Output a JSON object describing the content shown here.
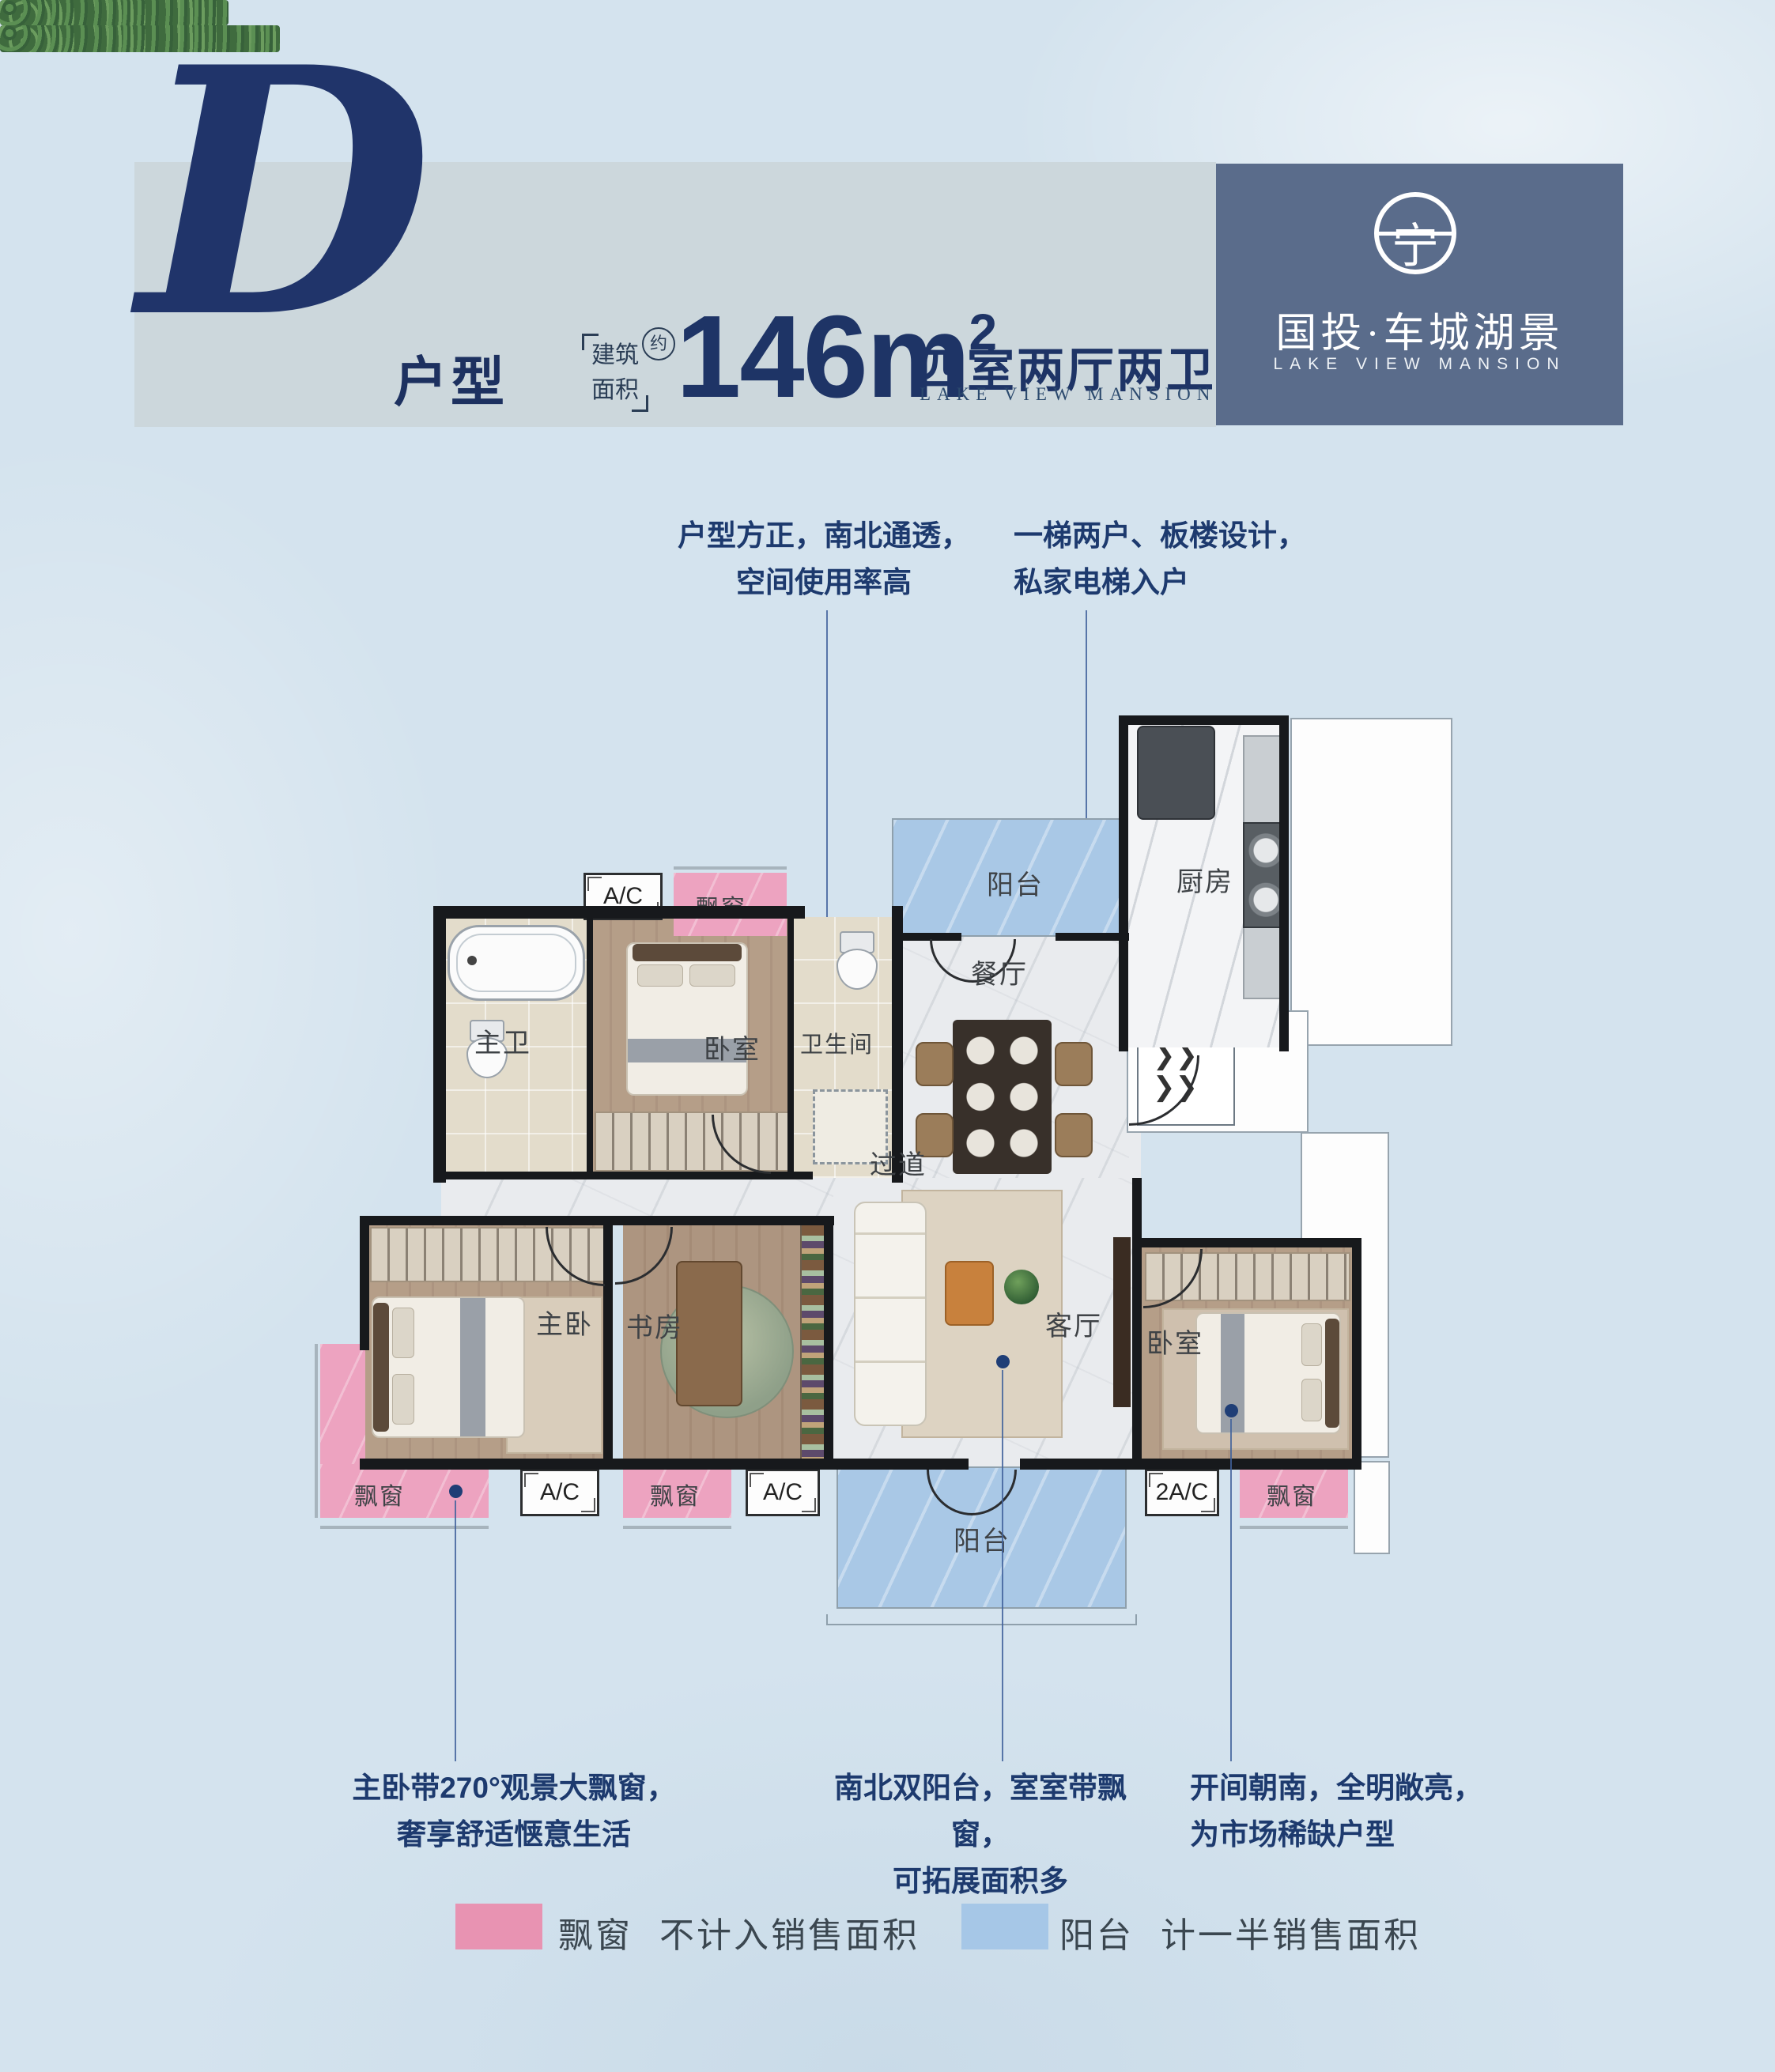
{
  "header": {
    "letter": "D",
    "letter_suffix": "户型",
    "area_label_line1": "建筑",
    "area_label_line2": "面积",
    "area_approx": "约",
    "area_value": "146m",
    "area_sup": "2",
    "spec": "四室两厅两卫",
    "spec_sub": "LAKE VIEW MANSION"
  },
  "brand": {
    "emblem_char": "宁",
    "name": "国投·车城湖景",
    "sub": "LAKE VIEW MANSION",
    "bg_color": "#5a6c8b"
  },
  "callouts": {
    "top_left": {
      "line1": "户型方正，南北通透，",
      "line2": "空间使用率高"
    },
    "top_right": {
      "line1": "一梯两户、板楼设计，",
      "line2": "私家电梯入户"
    },
    "bottom_left": {
      "line1": "主卧带270°观景大飘窗，",
      "line2": "奢享舒适惬意生活"
    },
    "bottom_mid": {
      "line1": "南北双阳台，室室带飘窗，",
      "line2": "可拓展面积多"
    },
    "bottom_right": {
      "line1": "开间朝南，全明敞亮，",
      "line2": "为市场稀缺户型"
    }
  },
  "plan": {
    "rooms": {
      "balcony_north": "阳台",
      "kitchen": "厨房",
      "master_bath": "主卫",
      "bedroom_north": "卧室",
      "bathroom": "卫生间",
      "dining": "餐厅",
      "corridor": "过道",
      "master_bedroom": "主卧",
      "study": "书房",
      "living": "客厅",
      "bedroom_south": "卧室",
      "balcony_south": "阳台"
    },
    "bays": {
      "top": "飘窗",
      "left": "飘窗",
      "mid": "飘窗",
      "right": "飘窗"
    },
    "ac": {
      "top": "A/C",
      "left": "A/C",
      "mid": "A/C",
      "right": "2A/C"
    },
    "colors": {
      "bay": "#eda3c0",
      "balcony": "#a9c8e6",
      "wall": "#17191c",
      "wood": "#b59e88",
      "marble": "#e9ebee"
    }
  },
  "legend": {
    "bay": {
      "label": "飘窗",
      "desc": "不计入销售面积",
      "color": "#e893b2"
    },
    "balcony": {
      "label": "阳台",
      "desc": "计一半销售面积",
      "color": "#a6c7e7"
    }
  }
}
